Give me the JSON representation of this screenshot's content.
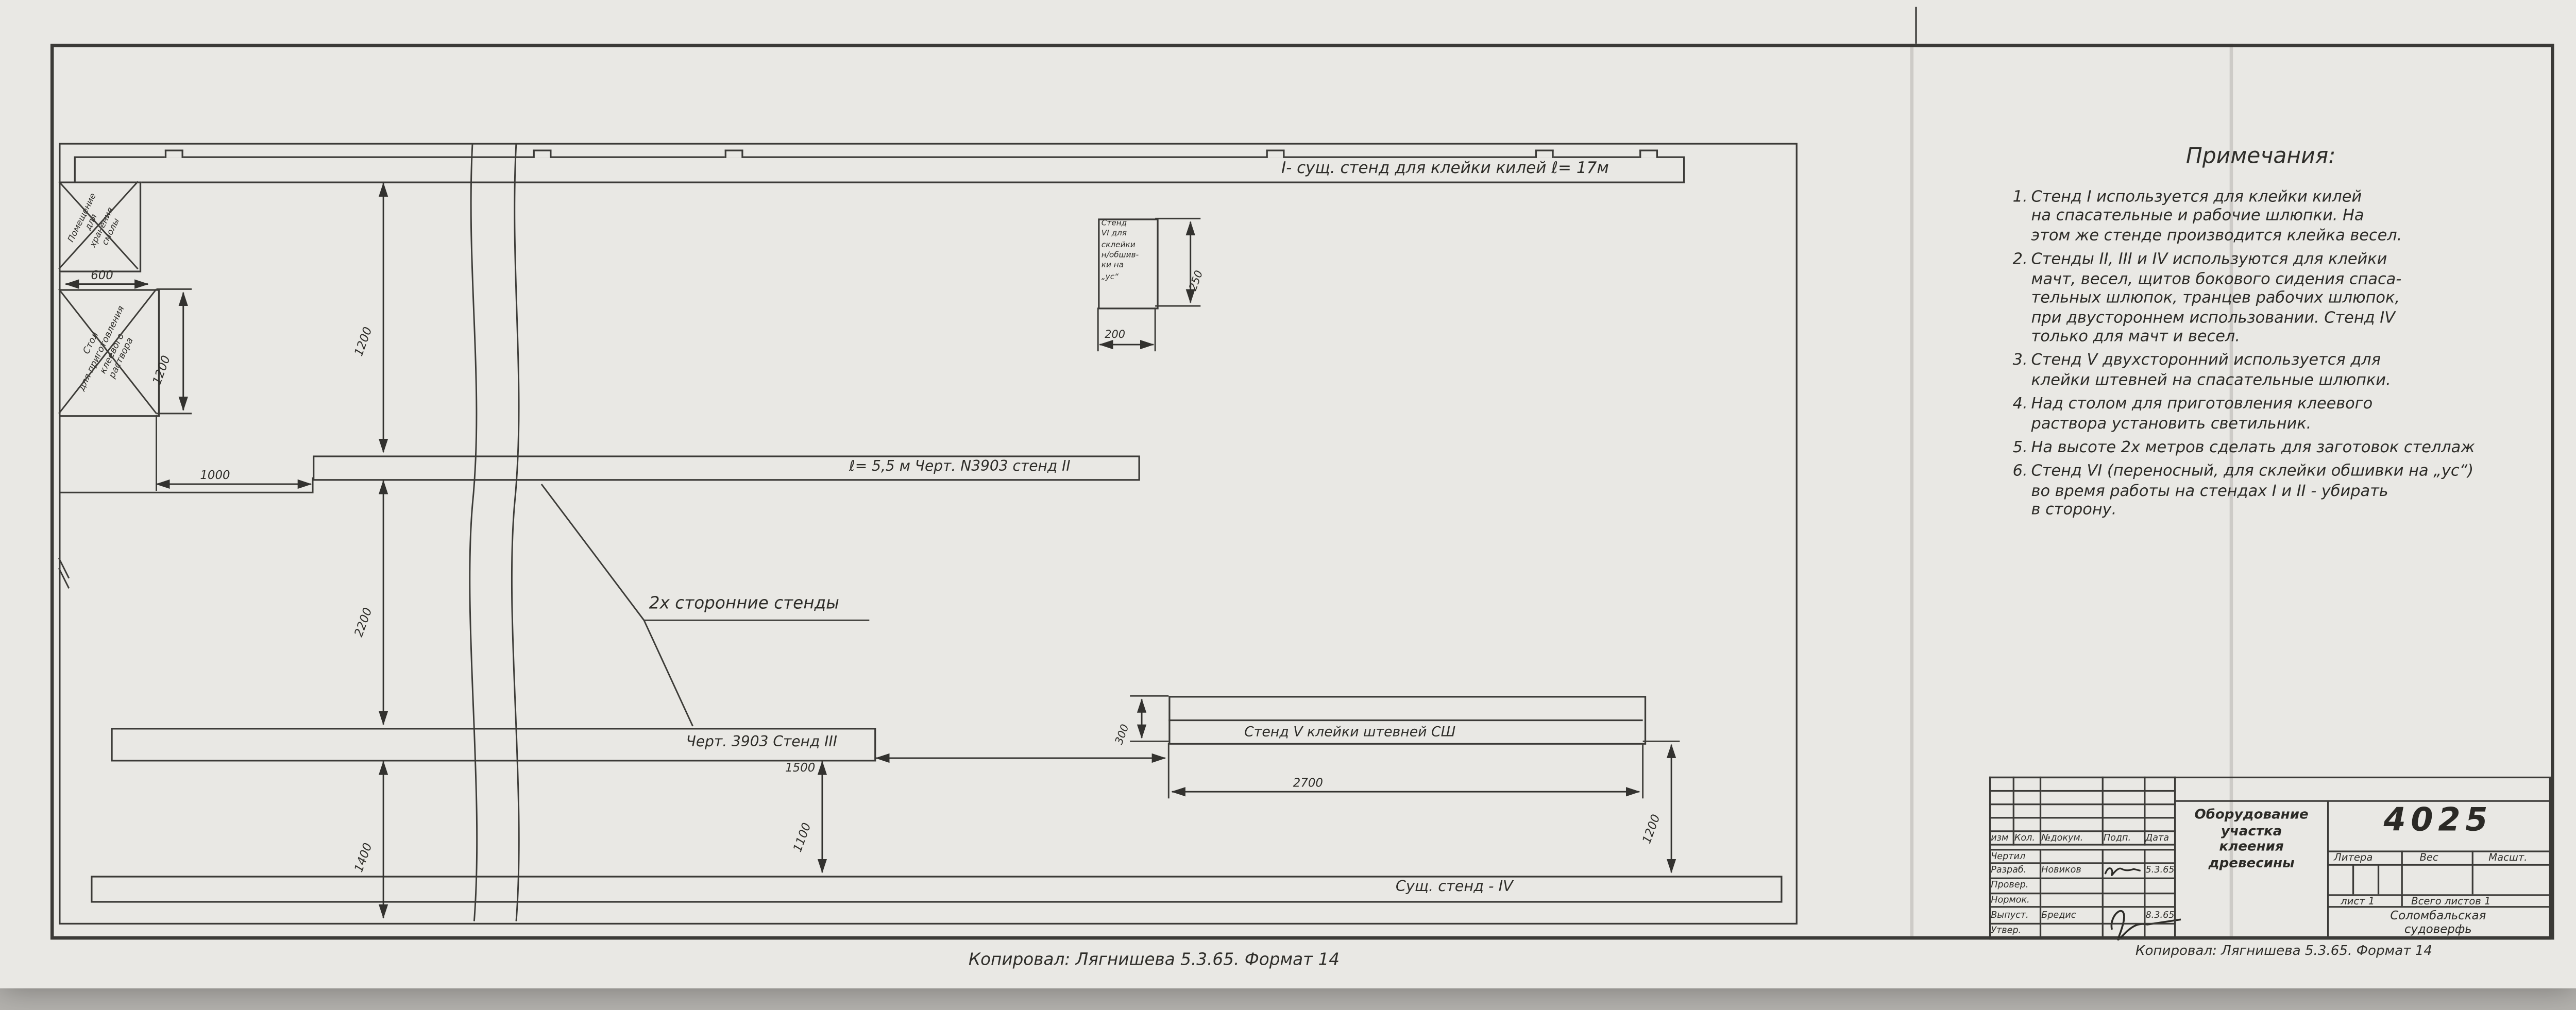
{
  "plan": {
    "stand1_label": "I- сущ. стенд для клейки килей  ℓ= 17м",
    "stand2_label": "ℓ= 5,5 м    Черт. N3903    стенд II",
    "stand3_label": "Черт. 3903    Стенд III",
    "stand4_label": "Сущ. стенд - IV",
    "stand5_label": "Стенд V    клейки штевней   СШ",
    "two_sided_label": "2х сторонние стенды",
    "room": {
      "l1": "Помещение",
      "l2": "для",
      "l3": "хранения",
      "l4": "смолы"
    },
    "table": {
      "l1": "Стол",
      "l2": "для приготовления",
      "l3": "клеевого",
      "l4": "раствора"
    },
    "stand6": {
      "l1": "Стенд",
      "l2": "VI для",
      "l3": "склейки",
      "l4": "н/обшив-",
      "l5": "ки на",
      "l6": "„ус“"
    },
    "dims": {
      "room_w": "600",
      "table_h": "1200",
      "table_gap": "1000",
      "i_ii": "1200",
      "ii_iii": "2200",
      "iii_wall": "1400",
      "iii_iv": "1100",
      "iii_v": "1500",
      "v_w": "2700",
      "v_iv": "1200",
      "v_h": "300",
      "vi_h": "250",
      "vi_w": "200"
    }
  },
  "notes": {
    "title": "Примечания:",
    "items": [
      {
        "num": "1.",
        "text": "Стенд I используется для клейки килей\nна спасательные и рабочие шлюпки. На\nэтом же стенде производится клейка весел."
      },
      {
        "num": "2.",
        "text": "Стенды II, III и IV используются для клейки\nмачт, весел, щитов бокового сидения спаса-\nтельных шлюпок, транцев рабочих шлюпок,\nпри двустороннем использовании. Стенд IV\nтолько для мачт и весел."
      },
      {
        "num": "3.",
        "text": "Стенд V двухсторонний используется для\nклейки штевней на спасательные шлюпки."
      },
      {
        "num": "4.",
        "text": "Над столом для приготовления клеевого\nраствора установить светильник."
      },
      {
        "num": "5.",
        "text": "На высоте 2х метров сделать для заготовок стеллаж"
      },
      {
        "num": "6.",
        "text": "Стенд VI (переносный, для склейки обшивки на „ус“)\nво время работы на стендах I и II - убирать\nв сторону."
      }
    ]
  },
  "title_block": {
    "doc_number": "4025",
    "title_l1": "Оборудование",
    "title_l2": "участка",
    "title_l3": "клеения",
    "title_l4": "древесины",
    "headers": {
      "izm": "изм",
      "kol": "Кол.",
      "docnum": "№докум.",
      "podp": "Подп.",
      "data": "Дата"
    },
    "rows": [
      {
        "role": "Чертил",
        "name": "",
        "date": ""
      },
      {
        "role": "Разраб.",
        "name": "Новиков",
        "date": "5.3.65"
      },
      {
        "role": "Провер.",
        "name": "",
        "date": ""
      },
      {
        "role": "Нормок.",
        "name": "",
        "date": ""
      },
      {
        "role": "Выпуст.",
        "name": "Бредис",
        "date": "8.3.65"
      },
      {
        "role": "Утвер.",
        "name": "",
        "date": ""
      }
    ],
    "litera": "Литера",
    "ves": "Вес",
    "masshtab": "Масшт.",
    "list": "лист 1",
    "vsego": "Всего листов 1",
    "org_l1": "Соломбальская",
    "org_l2": "судоверфь"
  },
  "footer": {
    "copied": "Копировал: Лягнишева   5.3.65.   Формат 14"
  }
}
